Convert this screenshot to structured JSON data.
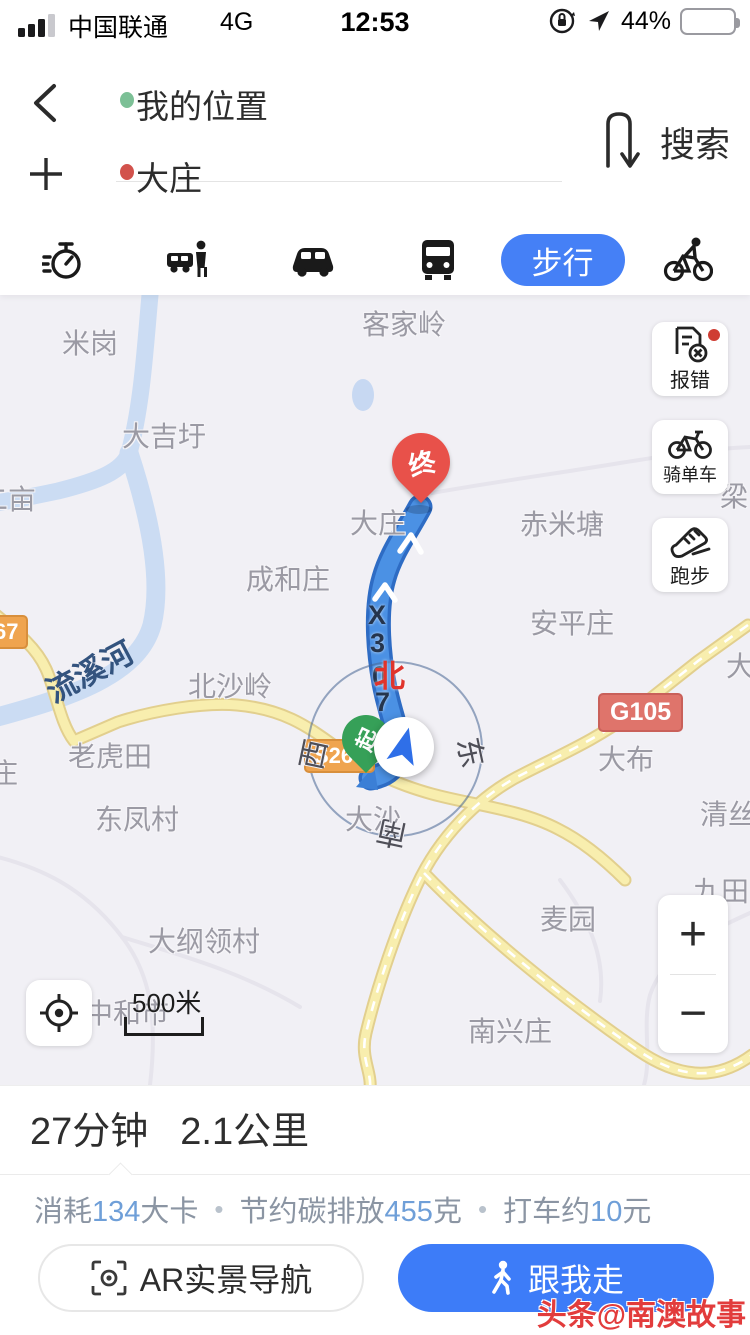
{
  "status_bar": {
    "carrier": "中国联通",
    "network": "4G",
    "time": "12:53",
    "battery_percent": "44%",
    "battery_color": "#f2cf5a",
    "icons": [
      "signal-bars-icon",
      "orientation-lock-icon",
      "location-arrow-icon",
      "battery-icon"
    ]
  },
  "search_panel": {
    "origin": "我的位置",
    "destination": "大庄",
    "search_label": "搜索",
    "origin_dot_color": "#7cc096",
    "destination_dot_color": "#d2524c",
    "icons": [
      "back-chevron-icon",
      "plus-icon",
      "swap-vertical-icon"
    ]
  },
  "transport_tabs": {
    "selected_color": "#4580f6",
    "items": [
      {
        "name": "timer",
        "icon": "stopwatch-icon"
      },
      {
        "name": "taxi",
        "icon": "taxi-icon"
      },
      {
        "name": "drive",
        "icon": "car-icon"
      },
      {
        "name": "transit",
        "icon": "bus-icon"
      },
      {
        "name": "walk",
        "label": "步行",
        "selected": true
      },
      {
        "name": "cycle",
        "icon": "cyclist-icon"
      }
    ]
  },
  "map": {
    "labels": [
      {
        "text": "米岗",
        "x": 62,
        "y": 27
      },
      {
        "text": "客家岭",
        "x": 362,
        "y": 8
      },
      {
        "text": "大吉圩",
        "x": 122,
        "y": 120
      },
      {
        "text": "二亩",
        "x": -20,
        "y": 183
      },
      {
        "text": "大庄",
        "x": 350,
        "y": 207
      },
      {
        "text": "赤米塘",
        "x": 520,
        "y": 208
      },
      {
        "text": "梁",
        "x": 720,
        "y": 180
      },
      {
        "text": "成和庄",
        "x": 246,
        "y": 263
      },
      {
        "text": "安平庄",
        "x": 530,
        "y": 307
      },
      {
        "text": "北沙岭",
        "x": 188,
        "y": 370
      },
      {
        "text": "大",
        "x": 726,
        "y": 350
      },
      {
        "text": "老虎田",
        "x": 68,
        "y": 440
      },
      {
        "text": "庄",
        "x": -10,
        "y": 457
      },
      {
        "text": "东凤村",
        "x": 95,
        "y": 503
      },
      {
        "text": "大沙",
        "x": 345,
        "y": 503
      },
      {
        "text": "大布",
        "x": 598,
        "y": 443
      },
      {
        "text": "清丝",
        "x": 700,
        "y": 498
      },
      {
        "text": "九田",
        "x": 693,
        "y": 575
      },
      {
        "text": "麦园",
        "x": 540,
        "y": 603
      },
      {
        "text": "大纲领村",
        "x": 148,
        "y": 625
      },
      {
        "text": "中和市",
        "x": 85,
        "y": 697
      },
      {
        "text": "南兴庄",
        "x": 468,
        "y": 715
      }
    ],
    "river_label": {
      "text": "流溪河",
      "x": 42,
      "y": 352,
      "rotation": -28
    },
    "shields": [
      {
        "text": "67",
        "x": -16,
        "y": 320,
        "type": "provincial"
      },
      {
        "text": "S267",
        "x": 304,
        "y": 444,
        "type": "provincial"
      },
      {
        "text": "G105",
        "x": 598,
        "y": 398,
        "type": "national"
      }
    ],
    "route_road_chars": [
      "X",
      "3",
      "0",
      "7"
    ],
    "compass": {
      "north": "北",
      "east": "东",
      "south": "南",
      "west": "西"
    },
    "end_pin_label": "终",
    "start_pin_label": "起",
    "side_buttons": [
      {
        "label": "报错",
        "icon": "report-error-icon",
        "badge": true
      },
      {
        "label": "骑单车",
        "icon": "bicycle-icon",
        "badge": false
      },
      {
        "label": "跑步",
        "icon": "running-shoe-icon",
        "badge": false
      }
    ],
    "zoom_in": "+",
    "zoom_out": "−",
    "scale_label": "500米",
    "route_color": "#4b91e4"
  },
  "route_summary": {
    "duration": "27分钟",
    "distance": "2.1公里",
    "stats": [
      {
        "prefix": "消耗",
        "value": "134",
        "suffix": "大卡"
      },
      {
        "prefix": "节约碳排放",
        "value": "455",
        "suffix": "克"
      },
      {
        "prefix": "打车约",
        "value": "10",
        "suffix": "元"
      }
    ],
    "ar_button": "AR实景导航",
    "follow_button": "跟我走"
  },
  "watermark": "头条@南澳故事"
}
